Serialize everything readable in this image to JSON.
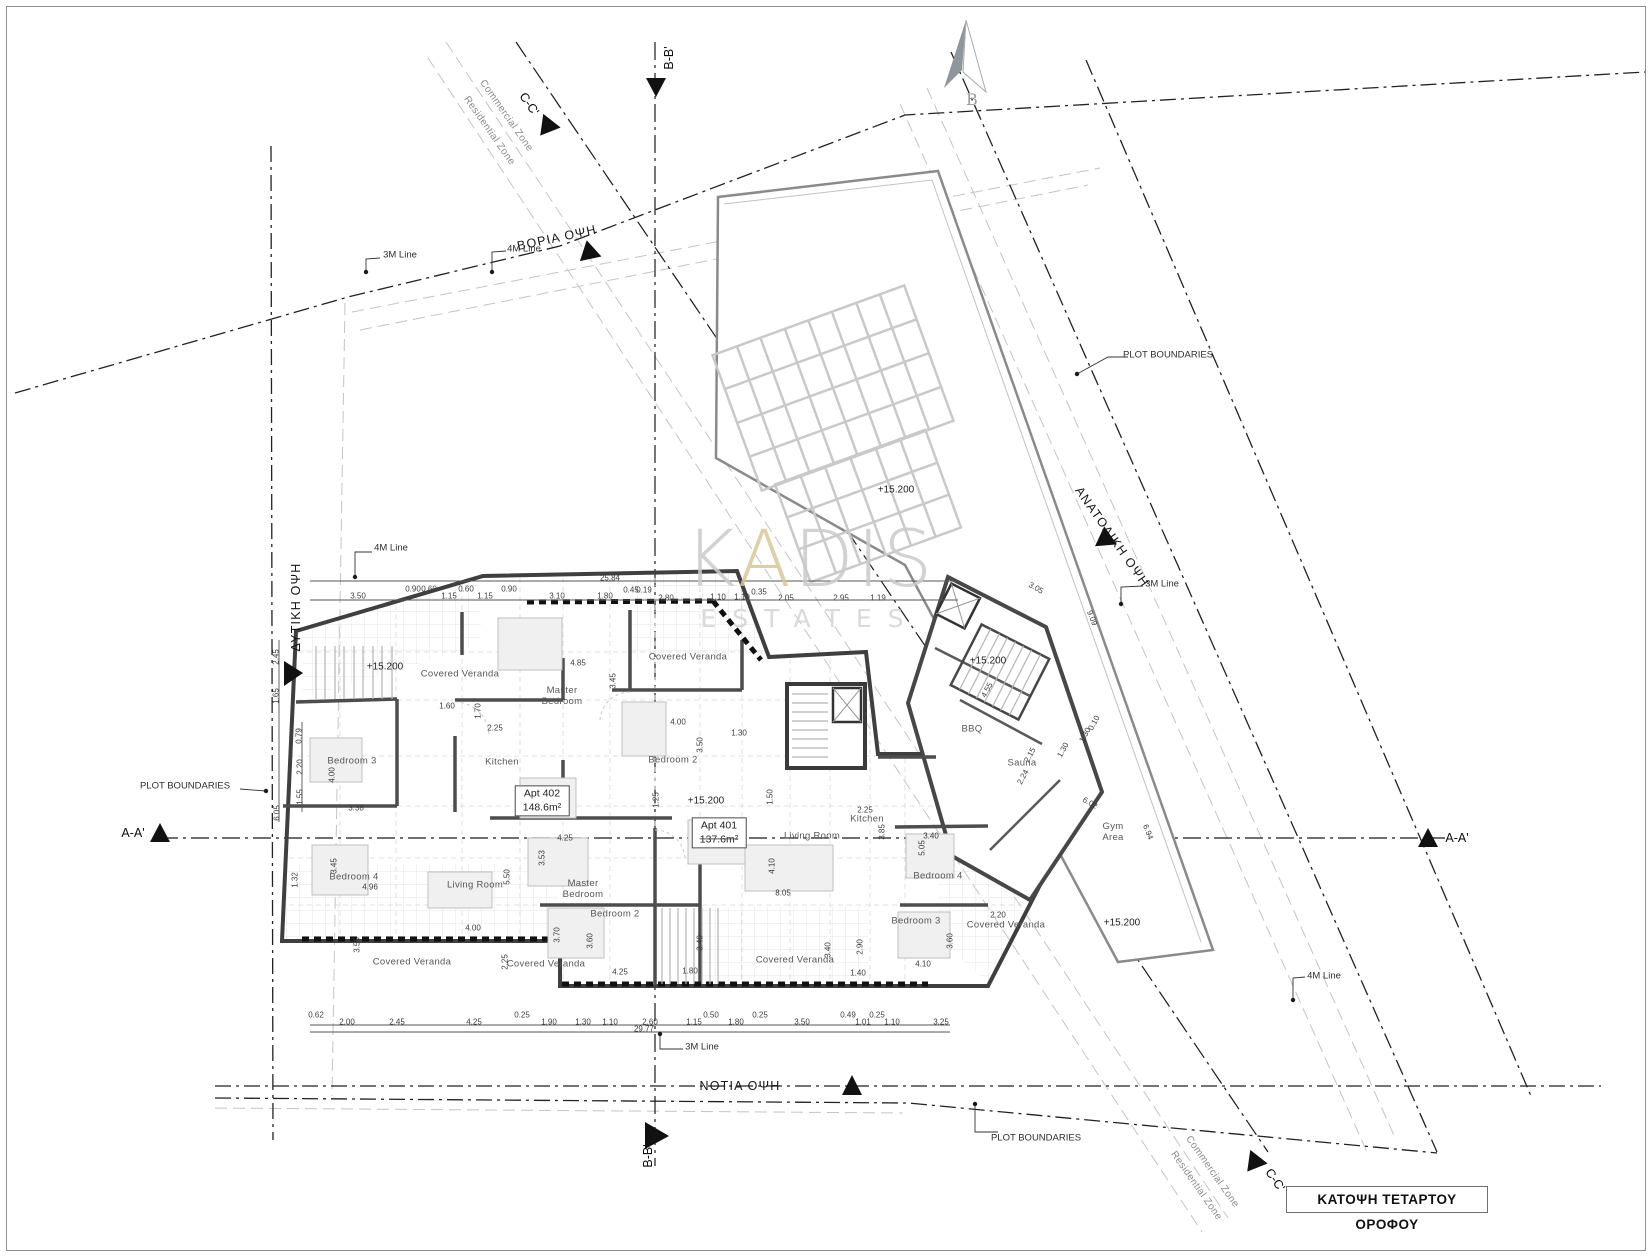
{
  "title_box": {
    "label": "ΚΑΤΟΨΗ ΤΕΤΑΡΤΟΥ ΟΡΟΦΟΥ"
  },
  "watermark": {
    "k": "K",
    "a": "A",
    "dis": "DIS",
    "estates": "ESTATES",
    "accent_color": "#d8c79c",
    "gray_color": "#cbcbcb"
  },
  "north_arrow": {
    "label": "B"
  },
  "apartments": [
    {
      "name": "Apt 402",
      "area": "148.6m²"
    },
    {
      "name": "Apt 401",
      "area": "137.6m²"
    }
  ],
  "facade_labels": [
    {
      "t": "ΒΟΡΙΑ ΟΨΗ",
      "x": 557,
      "y": 238,
      "r": -12
    },
    {
      "t": "ΝΟΤΙΑ ΟΨΗ",
      "x": 740,
      "y": 1086,
      "r": 0
    },
    {
      "t": "ΔΥΤΙΚΗ ΟΨΗ",
      "x": 296,
      "y": 607,
      "r": -90
    },
    {
      "t": "ΑΝΑΤΟΛΙΚΗ ΟΨΗ",
      "x": 1112,
      "y": 537,
      "r": 55
    }
  ],
  "section_labels": [
    {
      "t": "A-A'",
      "x": 133,
      "y": 833,
      "r": 0
    },
    {
      "t": "A-A'",
      "x": 1457,
      "y": 838,
      "r": 0
    },
    {
      "t": "B-B'",
      "x": 669,
      "y": 58,
      "r": -90
    },
    {
      "t": "B-B'",
      "x": 648,
      "y": 1156,
      "r": -90
    },
    {
      "t": "C-C'",
      "x": 529,
      "y": 104,
      "r": 55
    },
    {
      "t": "C-C'",
      "x": 1275,
      "y": 1180,
      "r": 55
    }
  ],
  "zone_labels": [
    {
      "t": "Commercial Zone",
      "x": 506,
      "y": 116,
      "r": 55
    },
    {
      "t": "Residential Zone",
      "x": 489,
      "y": 131,
      "r": 55
    },
    {
      "t": "Commercial Zone",
      "x": 1212,
      "y": 1172,
      "r": 55
    },
    {
      "t": "Residential Zone",
      "x": 1196,
      "y": 1186,
      "r": 55
    }
  ],
  "leader_labels": [
    {
      "t": "PLOT BOUNDARIES",
      "x": 185,
      "y": 787,
      "r": 0
    },
    {
      "t": "PLOT BOUNDARIES",
      "x": 1168,
      "y": 356,
      "r": 0
    },
    {
      "t": "PLOT BOUNDARIES",
      "x": 1036,
      "y": 1139,
      "r": 0
    },
    {
      "t": "3M Line",
      "x": 400,
      "y": 256,
      "r": 0
    },
    {
      "t": "4M Line",
      "x": 524,
      "y": 250,
      "r": 0
    },
    {
      "t": "4M Line",
      "x": 391,
      "y": 549,
      "r": 0
    },
    {
      "t": "3M Line",
      "x": 1162,
      "y": 585,
      "r": 0
    },
    {
      "t": "4M Line",
      "x": 1324,
      "y": 977,
      "r": 0
    },
    {
      "t": "3M Line",
      "x": 702,
      "y": 1048,
      "r": 0
    }
  ],
  "spot_elevations": [
    {
      "t": "+15.200",
      "x": 385,
      "y": 667
    },
    {
      "t": "+15.200",
      "x": 706,
      "y": 801
    },
    {
      "t": "+15.200",
      "x": 988,
      "y": 661
    },
    {
      "t": "+15.200",
      "x": 896,
      "y": 490
    },
    {
      "t": "+15.200",
      "x": 1122,
      "y": 923
    }
  ],
  "rooms": [
    {
      "t": "Covered Veranda",
      "x": 460,
      "y": 675
    },
    {
      "t": "Covered Veranda",
      "x": 688,
      "y": 658
    },
    {
      "t": "Master\nBedroom",
      "x": 562,
      "y": 697
    },
    {
      "t": "Kitchen",
      "x": 502,
      "y": 763
    },
    {
      "t": "Bedroom 2",
      "x": 673,
      "y": 761
    },
    {
      "t": "Bedroom 3",
      "x": 352,
      "y": 762
    },
    {
      "t": "Bedroom 4",
      "x": 354,
      "y": 878
    },
    {
      "t": "Living Room",
      "x": 475,
      "y": 886
    },
    {
      "t": "Master\nBedroom",
      "x": 583,
      "y": 890
    },
    {
      "t": "Bedroom 2",
      "x": 615,
      "y": 915
    },
    {
      "t": "Covered Veranda",
      "x": 412,
      "y": 963
    },
    {
      "t": "Covered Veranda",
      "x": 546,
      "y": 965
    },
    {
      "t": "Covered Veranda",
      "x": 795,
      "y": 961
    },
    {
      "t": "Living Room",
      "x": 812,
      "y": 837
    },
    {
      "t": "Kitchen",
      "x": 867,
      "y": 820
    },
    {
      "t": "Bedroom 4",
      "x": 938,
      "y": 877
    },
    {
      "t": "Bedroom 3",
      "x": 916,
      "y": 922
    },
    {
      "t": "Covered Veranda",
      "x": 1006,
      "y": 926
    },
    {
      "t": "Sauna",
      "x": 1022,
      "y": 764
    },
    {
      "t": "BBQ",
      "x": 972,
      "y": 730
    },
    {
      "t": "Gym\nArea",
      "x": 1113,
      "y": 833
    }
  ],
  "dimensions": [
    {
      "t": "25.84",
      "x": 610,
      "y": 578
    },
    {
      "t": "3.50",
      "x": 358,
      "y": 596
    },
    {
      "t": "0.90",
      "x": 413,
      "y": 589
    },
    {
      "t": "0.60",
      "x": 429,
      "y": 589
    },
    {
      "t": "1.15",
      "x": 449,
      "y": 596
    },
    {
      "t": "0.60",
      "x": 466,
      "y": 589
    },
    {
      "t": "1.15",
      "x": 485,
      "y": 596
    },
    {
      "t": "0.90",
      "x": 509,
      "y": 589
    },
    {
      "t": "3.10",
      "x": 557,
      "y": 596
    },
    {
      "t": "1.80",
      "x": 605,
      "y": 596
    },
    {
      "t": "0.45",
      "x": 631,
      "y": 590
    },
    {
      "t": "0.19",
      "x": 644,
      "y": 590
    },
    {
      "t": "2.80",
      "x": 666,
      "y": 598
    },
    {
      "t": "1.10",
      "x": 718,
      "y": 597
    },
    {
      "t": "1.10",
      "x": 742,
      "y": 597
    },
    {
      "t": "0.35",
      "x": 759,
      "y": 592
    },
    {
      "t": "2.05",
      "x": 786,
      "y": 598
    },
    {
      "t": "2.95",
      "x": 841,
      "y": 598
    },
    {
      "t": "1.19",
      "x": 878,
      "y": 598
    },
    {
      "t": "2.45",
      "x": 276,
      "y": 657,
      "r": -90
    },
    {
      "t": "1.65",
      "x": 276,
      "y": 696,
      "r": -90
    },
    {
      "t": "0.79",
      "x": 299,
      "y": 736,
      "r": -90
    },
    {
      "t": "2.20",
      "x": 300,
      "y": 767,
      "r": -90
    },
    {
      "t": "1.55",
      "x": 300,
      "y": 797,
      "r": -90
    },
    {
      "t": "6.05",
      "x": 277,
      "y": 813,
      "r": -90
    },
    {
      "t": "1.32",
      "x": 295,
      "y": 880,
      "r": -90
    },
    {
      "t": "4.85",
      "x": 578,
      "y": 663
    },
    {
      "t": "3.45",
      "x": 613,
      "y": 681,
      "r": -90
    },
    {
      "t": "1.60",
      "x": 447,
      "y": 706
    },
    {
      "t": "1.70",
      "x": 478,
      "y": 711,
      "r": -90
    },
    {
      "t": "2.25",
      "x": 495,
      "y": 728
    },
    {
      "t": "4.00",
      "x": 678,
      "y": 722
    },
    {
      "t": "3.50",
      "x": 700,
      "y": 745,
      "r": -90
    },
    {
      "t": "1.30",
      "x": 739,
      "y": 733
    },
    {
      "t": "4.00",
      "x": 332,
      "y": 775,
      "r": -90
    },
    {
      "t": "3.38",
      "x": 356,
      "y": 808
    },
    {
      "t": "3.45",
      "x": 334,
      "y": 866,
      "r": -90
    },
    {
      "t": "4.96",
      "x": 370,
      "y": 887
    },
    {
      "t": "4.00",
      "x": 473,
      "y": 928
    },
    {
      "t": "3.55",
      "x": 357,
      "y": 945,
      "r": -90
    },
    {
      "t": "2.25",
      "x": 505,
      "y": 962,
      "r": -90
    },
    {
      "t": "3.70",
      "x": 557,
      "y": 935,
      "r": -90
    },
    {
      "t": "3.60",
      "x": 590,
      "y": 941,
      "r": -90
    },
    {
      "t": "4.25",
      "x": 565,
      "y": 838
    },
    {
      "t": "5.50",
      "x": 507,
      "y": 877,
      "r": -90
    },
    {
      "t": "3.53",
      "x": 542,
      "y": 858,
      "r": -90
    },
    {
      "t": "4.25",
      "x": 620,
      "y": 972
    },
    {
      "t": "1.80",
      "x": 690,
      "y": 971
    },
    {
      "t": "1.25",
      "x": 656,
      "y": 800,
      "r": -90
    },
    {
      "t": "1.50",
      "x": 770,
      "y": 797,
      "r": -90
    },
    {
      "t": "2.25",
      "x": 865,
      "y": 810
    },
    {
      "t": "3.85",
      "x": 882,
      "y": 832,
      "r": -90
    },
    {
      "t": "5.05",
      "x": 922,
      "y": 848,
      "r": -90
    },
    {
      "t": "3.40",
      "x": 931,
      "y": 836
    },
    {
      "t": "8.05",
      "x": 783,
      "y": 893
    },
    {
      "t": "4.10",
      "x": 772,
      "y": 866,
      "r": -90
    },
    {
      "t": "3.40",
      "x": 700,
      "y": 943,
      "r": -90
    },
    {
      "t": "3.40",
      "x": 828,
      "y": 950,
      "r": -90
    },
    {
      "t": "2.90",
      "x": 860,
      "y": 947,
      "r": -90
    },
    {
      "t": "3.60",
      "x": 950,
      "y": 941,
      "r": -90
    },
    {
      "t": "4.10",
      "x": 923,
      "y": 964
    },
    {
      "t": "1.40",
      "x": 858,
      "y": 973
    },
    {
      "t": "2.20",
      "x": 998,
      "y": 915
    },
    {
      "t": "4.55",
      "x": 987,
      "y": 690,
      "r": -62
    },
    {
      "t": "2.15",
      "x": 1030,
      "y": 755,
      "r": -62
    },
    {
      "t": "2.24",
      "x": 1023,
      "y": 777,
      "r": -62
    },
    {
      "t": "1.30",
      "x": 1063,
      "y": 750,
      "r": -62
    },
    {
      "t": "1.30",
      "x": 1085,
      "y": 735,
      "r": -62
    },
    {
      "t": "0.10",
      "x": 1094,
      "y": 723,
      "r": -62
    },
    {
      "t": "6.02",
      "x": 1090,
      "y": 803,
      "r": 30
    },
    {
      "t": "6.94",
      "x": 1148,
      "y": 832,
      "r": 68
    },
    {
      "t": "9.09",
      "x": 1092,
      "y": 618,
      "r": 68
    },
    {
      "t": "3.05",
      "x": 1036,
      "y": 588,
      "r": 30
    },
    {
      "t": "29.77",
      "x": 644,
      "y": 1029
    },
    {
      "t": "0.62",
      "x": 316,
      "y": 1015
    },
    {
      "t": "2.00",
      "x": 347,
      "y": 1022
    },
    {
      "t": "2.45",
      "x": 397,
      "y": 1022
    },
    {
      "t": "4.25",
      "x": 474,
      "y": 1022
    },
    {
      "t": "0.25",
      "x": 522,
      "y": 1015
    },
    {
      "t": "1.90",
      "x": 549,
      "y": 1022
    },
    {
      "t": "1.30",
      "x": 583,
      "y": 1022
    },
    {
      "t": "1.10",
      "x": 610,
      "y": 1022
    },
    {
      "t": "2.60",
      "x": 650,
      "y": 1022
    },
    {
      "t": "1.15",
      "x": 694,
      "y": 1022
    },
    {
      "t": "0.50",
      "x": 711,
      "y": 1015
    },
    {
      "t": "1.80",
      "x": 736,
      "y": 1022
    },
    {
      "t": "0.25",
      "x": 760,
      "y": 1015
    },
    {
      "t": "3.50",
      "x": 802,
      "y": 1022
    },
    {
      "t": "0.49",
      "x": 848,
      "y": 1015
    },
    {
      "t": "1.01",
      "x": 863,
      "y": 1022
    },
    {
      "t": "0.25",
      "x": 877,
      "y": 1015
    },
    {
      "t": "1.10",
      "x": 892,
      "y": 1022
    },
    {
      "t": "3.25",
      "x": 941,
      "y": 1022
    }
  ]
}
